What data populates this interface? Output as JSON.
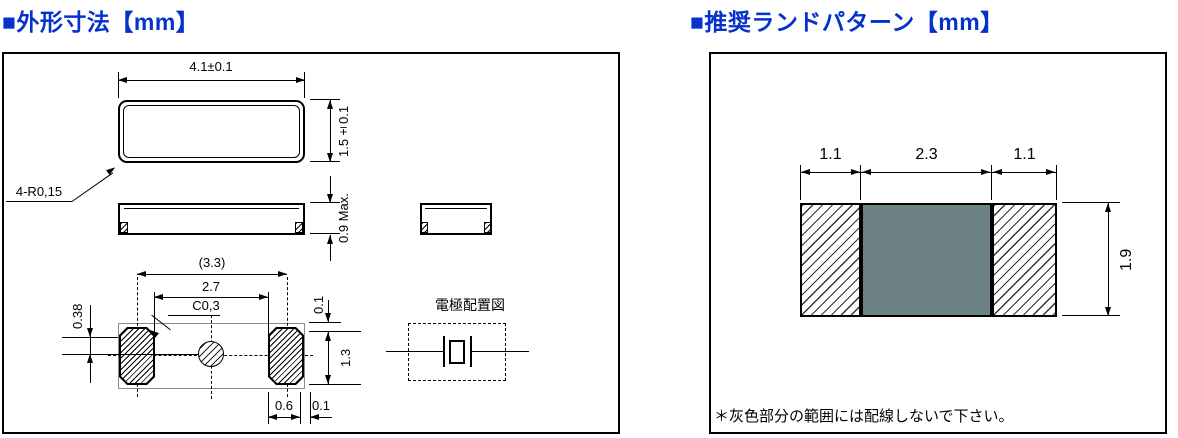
{
  "page": {
    "left_title": "■外形寸法【mm】",
    "right_title": "■推奨ランドパターン【mm】"
  },
  "colors": {
    "title_blue": "#0531cd",
    "keepout_gray": "#6d8285"
  },
  "outline": {
    "top_view": {
      "width_dim": "4.1±0.1",
      "height_dim": "1.5±0.1",
      "corner_note": "4-R0,15"
    },
    "side_view": {
      "height_dim": "0.9 Max."
    },
    "bottom_view": {
      "pad_pitch_ref": "(3.3)",
      "pad_inner_gap": "2.7",
      "chamfer_note": "C0,3",
      "mark_offset": "0.38",
      "top_gap": "0.1",
      "pad_height": "1.3",
      "pad_width": "0.6",
      "side_gap": "0.1"
    },
    "electrode_diagram_label": "電極配置図"
  },
  "land_pattern": {
    "left_pad_width": "1.1",
    "center_width": "2.3",
    "right_pad_width": "1.1",
    "height": "1.9",
    "note": "＊灰色部分の範囲には配線しないで下さい。"
  }
}
